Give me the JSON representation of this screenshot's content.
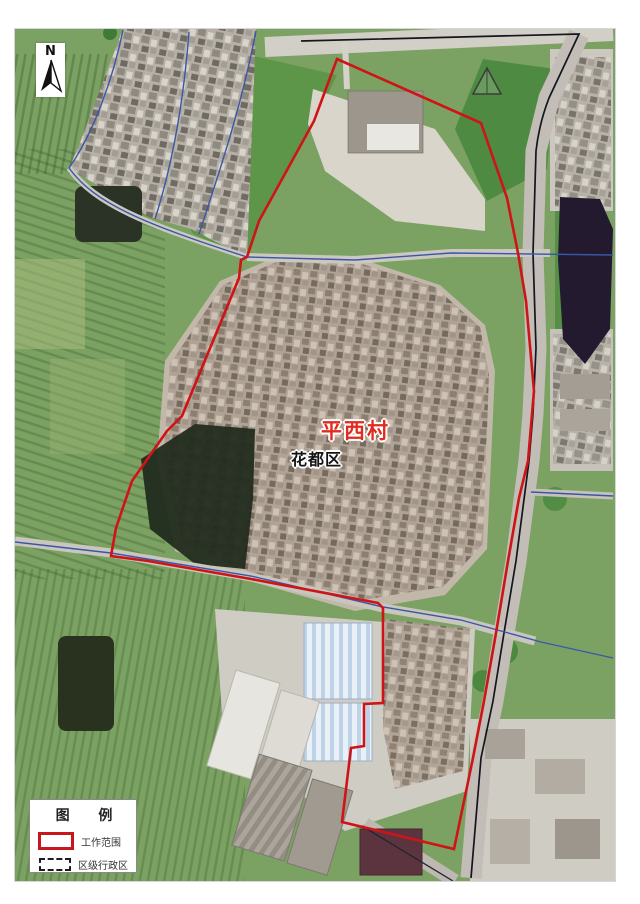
{
  "map": {
    "region_label": {
      "text": "平西村",
      "color": "#e02b1e"
    },
    "district_label": {
      "text": "花都区",
      "color": "#141414"
    },
    "north": {
      "letter": "N"
    },
    "legend": {
      "title": "图 例",
      "items": [
        {
          "label": "工作范围",
          "swatch": "red-solid-rect"
        },
        {
          "label": "区级行政区",
          "swatch": "black-dashed-rect"
        }
      ]
    },
    "colors": {
      "boundary_red": "#cf1417",
      "admin_blue": "#3a57a7",
      "road_black": "#15151d",
      "field_green": "#7ca263",
      "water_dark": "#241a30"
    }
  }
}
